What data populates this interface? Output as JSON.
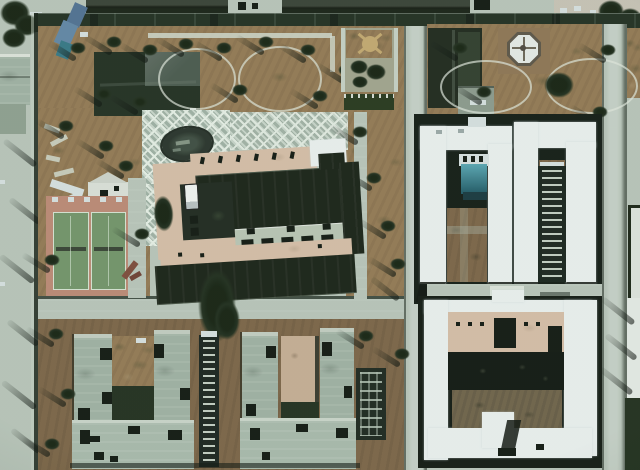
{
  "scene": {
    "type": "satellite-aerial-photograph",
    "description": "Overhead satellite view of a walled institutional compound: a landscaped north garden with winding paths, a dark hipped-roof building, a diamond-paved plaza with an oval pond, a large central building with twin dark-roofed wings, two green tennis courts on a salmon surround, white U-shaped roof blocks with inner courtyards to the east, gray-roofed barracks clusters to the south, and internal roads with perimeter walls."
  },
  "palette": {
    "road": "#b9c6ba",
    "wall-dark": "#1c2a1c",
    "ground": "#95784f",
    "ground-dark": "#7c6242",
    "dark-roof": "#141c11",
    "gray-roof": "#9fb2a3",
    "gray-roof-light": "#a9bbac",
    "white-roof": "#eef3f2",
    "white-dim": "#d9e3e3",
    "pink": "#d9bfa6",
    "pink-2": "#c9ae92",
    "salmon": "#c08872",
    "court-green": "#6f9466",
    "court-line": "#d8e6d4",
    "teal": "#2f8496",
    "teal-dark": "#175563",
    "blue-glass": "#4c6f93",
    "plaza": "#ccd9cd",
    "plaza-line": "#e9f1e8",
    "hedge": "#223317",
    "tree": "#1b2917",
    "shadow": "#0c130c",
    "pond": "#242f26",
    "brown-court": "#6e6045"
  },
  "landmarks": {
    "north_garden": "Landscaped garden with winding paths and trees",
    "hipped_roof_building": "Dark hipped-roof building in north garden",
    "blue_structure": "Blue glass-roofed structure",
    "lattice_plaza": "Diamond-paved plaza",
    "oval_pond": "Oval pond on plaza",
    "central_building": "Large central building with twin dark-roofed wings",
    "service_truck": "White vehicle parked at west courtyard",
    "tennis_courts": "Two green tennis courts on salmon surround",
    "garden_courtyard": "Small walled garden with radial path",
    "compass_rosette": "Octagonal pavilion on brown plot",
    "upper_block_west": "White U-shaped roof block with teal structure",
    "upper_block_east": "White U-shaped roof block with ladder walkway",
    "lower_block": "White rectangular courtyard block with pink inner building",
    "barracks_west": "Gray-roofed barracks cluster",
    "barracks_east": "Gray-roofed barracks cluster with pink inner block",
    "ladder_walkway": "Covered walkway with crossbars",
    "trellis": "Dark trellis structure",
    "road_vertical_center": "North-south internal road",
    "road_vertical_east": "Eastern internal road",
    "road_top": "East-west perimeter road with wall",
    "road_south": "Southern internal road"
  }
}
